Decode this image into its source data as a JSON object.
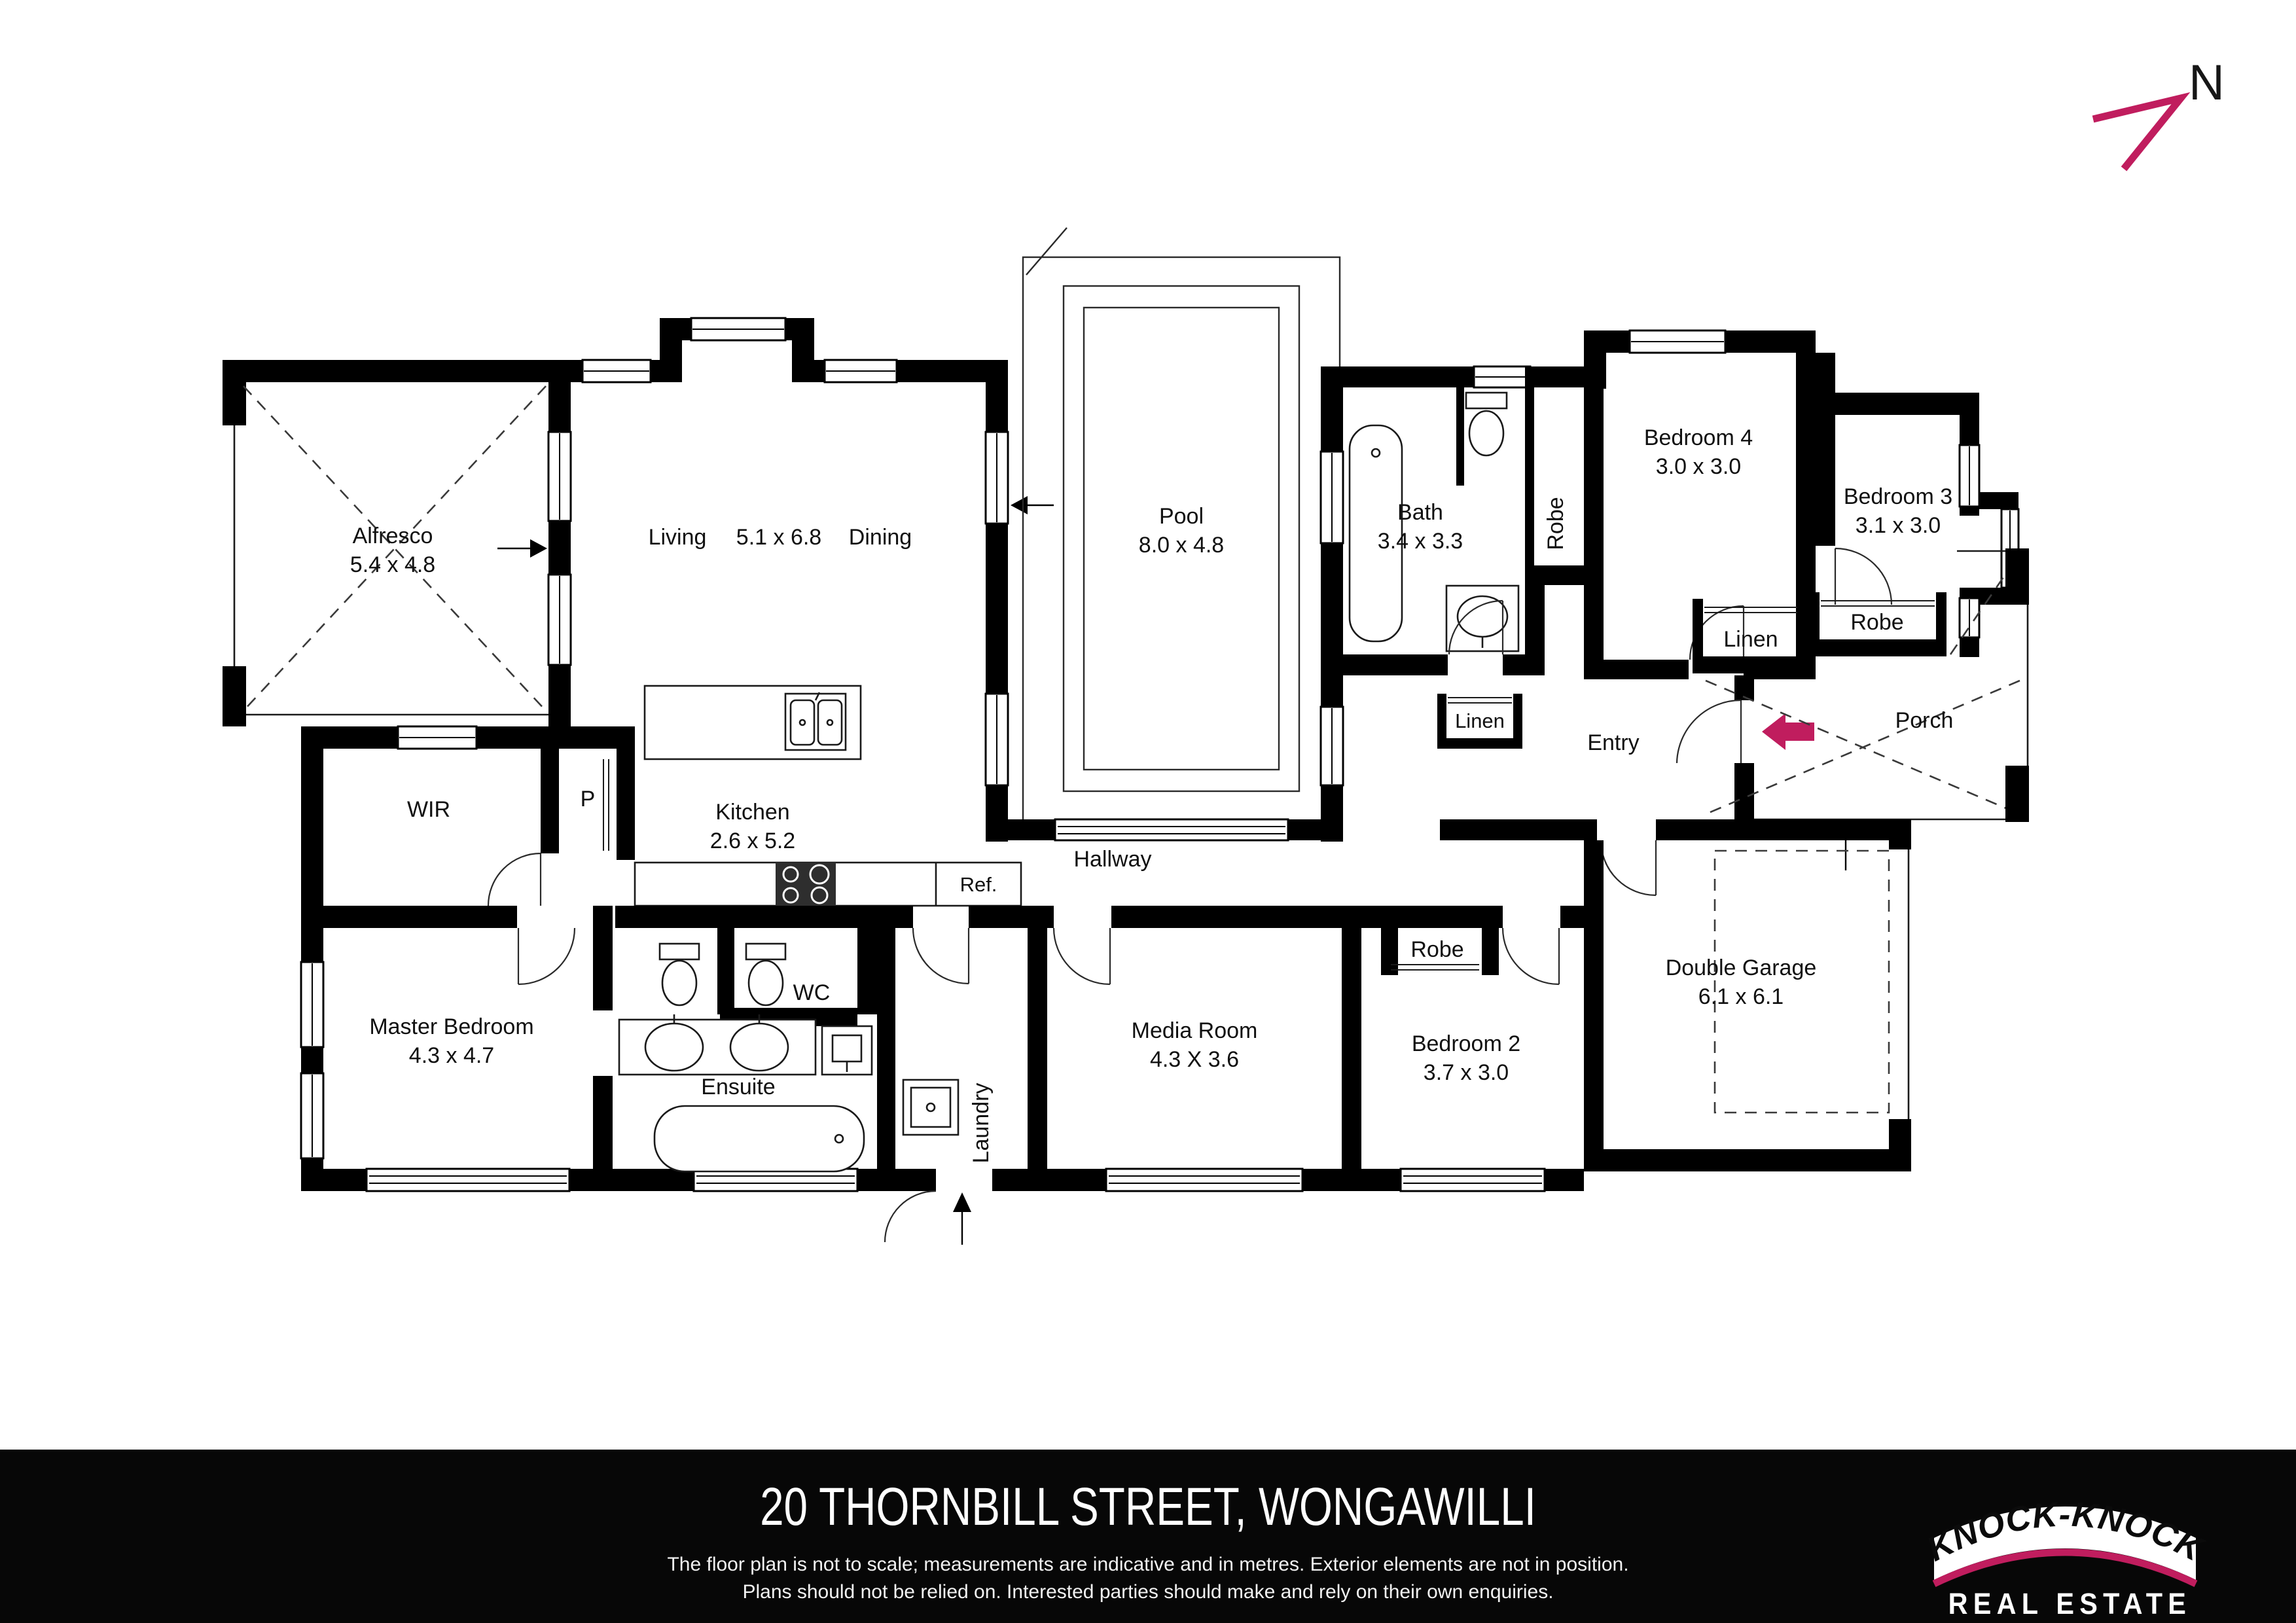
{
  "north": {
    "label": "N"
  },
  "rooms": {
    "alfresco": {
      "name": "Alfresco",
      "dims": "5.4 x 4.8"
    },
    "living": {
      "name": "Living",
      "dims": "5.1 x 6.8"
    },
    "dining": {
      "name": "Dining"
    },
    "pool": {
      "name": "Pool",
      "dims": "8.0 x 4.8"
    },
    "bath": {
      "name": "Bath",
      "dims": "3.4 x 3.3"
    },
    "bedroom4": {
      "name": "Bedroom 4",
      "dims": "3.0 x 3.0"
    },
    "bedroom3": {
      "name": "Bedroom 3",
      "dims": "3.1 x 3.0"
    },
    "kitchen": {
      "name": "Kitchen",
      "dims": "2.6 x 5.2"
    },
    "master": {
      "name": "Master Bedroom",
      "dims": "4.3 x 4.7"
    },
    "ensuite": {
      "name": "Ensuite",
      "dims": "2.1 x 2.8"
    },
    "media": {
      "name": "Media Room",
      "dims": "4.3 X 3.6"
    },
    "bedroom2": {
      "name": "Bedroom 2",
      "dims": "3.7 x 3.0"
    },
    "garage": {
      "name": "Double Garage",
      "dims": "6.1 x 6.1"
    },
    "hallway": {
      "name": "Hallway"
    },
    "entry": {
      "name": "Entry"
    },
    "porch": {
      "name": "Porch"
    },
    "wir": {
      "name": "WIR"
    },
    "pantry": {
      "name": "P"
    },
    "wc": {
      "name": "WC"
    },
    "laundry": {
      "name": "Laundry"
    },
    "fridge": {
      "name": "Ref."
    },
    "robe_bed4": {
      "name": "Robe"
    },
    "robe_bed3": {
      "name": "Robe"
    },
    "robe_bed2": {
      "name": "Robe"
    },
    "linen_hall": {
      "name": "Linen"
    },
    "linen_entry": {
      "name": "Linen"
    }
  },
  "footer": {
    "address": "20 THORNBILL STREET, WONGAWILLI",
    "disclaimer1": "The floor plan is not to scale; measurements are indicative and in metres. Exterior elements are not in position.",
    "disclaimer2": "Plans should not be relied on. Interested parties should make and rely on their own enquiries.",
    "logo_brand": "“KNOCK-KNOCK”",
    "logo_tagline": "REAL ESTATE"
  },
  "colors": {
    "accent": "#c01d5e",
    "wall": "#000000",
    "footer_bg": "#070707"
  }
}
